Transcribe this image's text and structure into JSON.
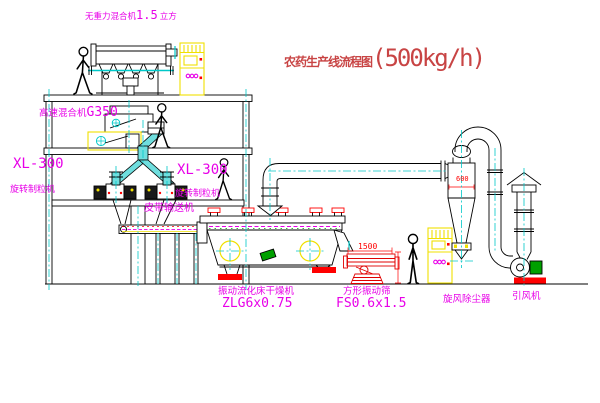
{
  "title": {
    "name": "农药生产线流程图",
    "capacity": "(500kg/h)"
  },
  "labels": {
    "gravity_mixer_name": "无重力混合机",
    "gravity_mixer_size": "1.5",
    "gravity_mixer_unit": "立方",
    "high_speed_mixer_name": "高速混合机",
    "high_speed_mixer_model": "G350",
    "granulator_left_model": "XL-300",
    "granulator_left_name": "旋转制粒机",
    "granulator_right_model": "XL-300",
    "granulator_right_name": "旋转制粒机",
    "belt_conveyor": "皮带输送机",
    "dryer_name": "振动流化床干燥机",
    "dryer_model": "ZLG6x0.75",
    "screen_name": "方形振动筛",
    "screen_model": "FS0.6x1.5",
    "cyclone_name": "旋风除尘器",
    "fan_name": "引风机"
  },
  "dimensions": {
    "screen_length": "1500",
    "cyclone_diameter": "600"
  },
  "colors": {
    "label_magenta": "#e800e8",
    "title_red": "#c84444",
    "dimension_red": "#ff0000",
    "pipe_cyan": "#00c8c8",
    "cabinet_yellow": "#f0e000",
    "motor_green": "#00a000",
    "line_black": "#000000"
  }
}
